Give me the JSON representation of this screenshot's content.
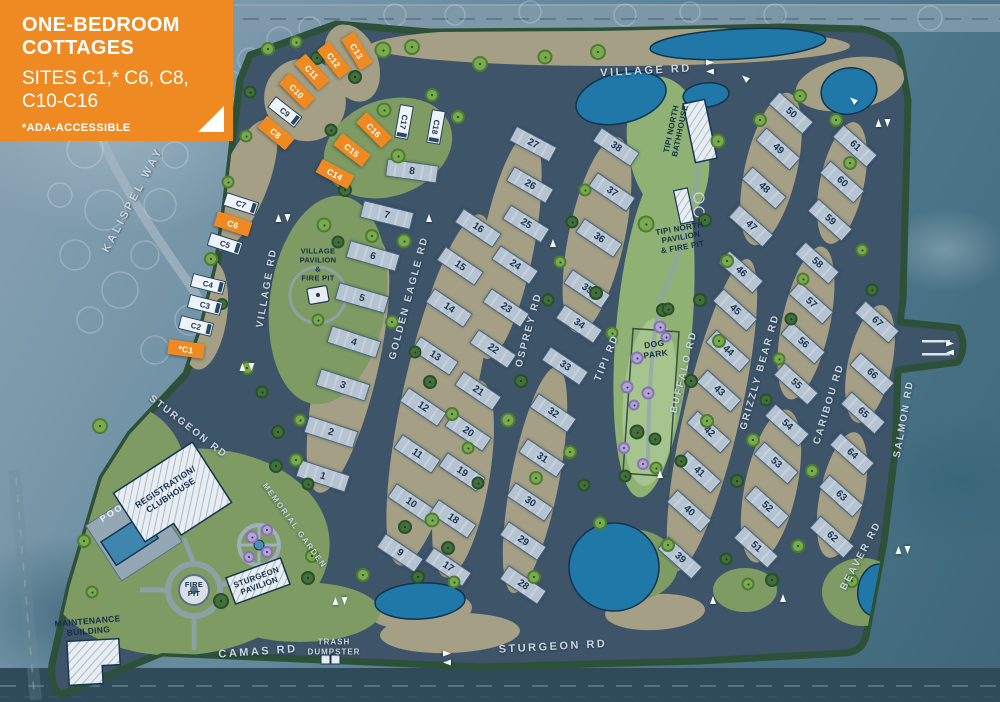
{
  "callout": {
    "title1": "ONE-BEDROOM",
    "title2": "COTTAGES",
    "sites_line1": "SITES C1,* C6, C8,",
    "sites_line2": "C10-C16",
    "note": "*ADA-ACCESSIBLE"
  },
  "colors": {
    "highlight_orange": "#ef8a23",
    "road_asphalt": "#3e5469",
    "gravel_tan": "#a5a085",
    "lawn_green": "#7d9b63",
    "pond_blue": "#1f78a8",
    "pad_gray": "#b6c3d1",
    "perimeter_green": "#2d5039"
  },
  "roads": [
    [
      "KALISPEL WAY",
      133,
      200,
      -62,
      11,
      3
    ],
    [
      "VILLAGE RD",
      267,
      288,
      -80,
      10,
      2
    ],
    [
      "VILLAGE RD",
      646,
      71,
      -3,
      11,
      2.5
    ],
    [
      "STURGEON RD",
      188,
      427,
      38,
      10,
      2
    ],
    [
      "STURGEON RD",
      553,
      647,
      -3,
      11,
      2.5
    ],
    [
      "CAMAS RD",
      258,
      652,
      -4,
      11,
      2.5
    ],
    [
      "GOLDEN EAGLE RD",
      409,
      298,
      -75,
      10,
      2
    ],
    [
      "OSPREY RD",
      529,
      330,
      -75,
      10,
      2
    ],
    [
      "TIPI RD",
      607,
      358,
      -68,
      10,
      2
    ],
    [
      "BUFFALO RD",
      684,
      372,
      -76,
      10,
      2
    ],
    [
      "GRIZZLY BEAR RD",
      760,
      372,
      -74,
      10,
      2
    ],
    [
      "CARIBOU RD",
      829,
      404,
      -73,
      10,
      2
    ],
    [
      "SALMON RD",
      904,
      419,
      -80,
      10,
      2
    ],
    [
      "BEAVER RD",
      861,
      556,
      -62,
      10,
      2
    ],
    [
      "MEMORIAL GARDEN",
      294,
      526,
      54,
      8,
      1.5
    ],
    [
      "TRASH\nDUMPSTER",
      334,
      648,
      0,
      8,
      1
    ]
  ],
  "amenities": [
    [
      "VILLAGE\nPAVILION\n&\nFIRE PIT",
      318,
      265,
      0,
      7.5,
      0
    ],
    [
      "TIPI NORTH\nBATHHOUSE",
      676,
      130,
      -78,
      8,
      0
    ],
    [
      "TIPI NORTH\nPAVILION\n& FIRE PIT",
      681,
      238,
      -10,
      8,
      0
    ],
    [
      "DOG\nPARK",
      655,
      349,
      -8,
      8.5,
      0
    ],
    [
      "REGISTRATION/\nCLUBHOUSE",
      168,
      491,
      -33,
      8.5,
      0
    ],
    [
      "POOL",
      115,
      511,
      -33,
      9,
      1
    ],
    [
      "FIRE\nPIT",
      194,
      590,
      0,
      7.5,
      0
    ],
    [
      "STURGEON\nPAVILION",
      258,
      582,
      -20,
      8,
      0
    ],
    [
      "MAINTENANCE\nBUILDING",
      88,
      626,
      -5,
      8.5,
      0
    ]
  ],
  "cottages": [
    [
      "*C1",
      186,
      349,
      8,
      1
    ],
    [
      "C2",
      196,
      326,
      14,
      0
    ],
    [
      "C3",
      205,
      305,
      14,
      0
    ],
    [
      "C4",
      208,
      284,
      14,
      0
    ],
    [
      "C5",
      225,
      244,
      18,
      0
    ],
    [
      "C6",
      233,
      224,
      18,
      1
    ],
    [
      "C7",
      241,
      204,
      18,
      0
    ],
    [
      "C8",
      276,
      133,
      40,
      1
    ],
    [
      "C9",
      285,
      112,
      38,
      0
    ],
    [
      "C10",
      297,
      91,
      45,
      1
    ],
    [
      "C11",
      312,
      72,
      48,
      1
    ],
    [
      "C12",
      334,
      60,
      52,
      1
    ],
    [
      "C13",
      357,
      51,
      58,
      1
    ],
    [
      "C14",
      335,
      174,
      28,
      1
    ],
    [
      "C15",
      352,
      150,
      38,
      1
    ],
    [
      "C16",
      374,
      130,
      45,
      1
    ],
    [
      "C17",
      404,
      122,
      100,
      0
    ],
    [
      "C18",
      436,
      127,
      100,
      0
    ]
  ],
  "sites": [
    [
      1,
      323,
      476,
      18
    ],
    [
      2,
      331,
      432,
      18
    ],
    [
      3,
      343,
      385,
      18
    ],
    [
      4,
      354,
      342,
      18
    ],
    [
      5,
      362,
      298,
      16
    ],
    [
      6,
      373,
      256,
      16
    ],
    [
      7,
      387,
      215,
      14
    ],
    [
      8,
      412,
      171,
      8
    ],
    [
      9,
      400,
      553,
      34
    ],
    [
      10,
      411,
      503,
      34
    ],
    [
      11,
      417,
      454,
      34
    ],
    [
      12,
      423,
      407,
      34
    ],
    [
      13,
      435,
      356,
      34
    ],
    [
      14,
      449,
      308,
      34
    ],
    [
      15,
      460,
      266,
      34
    ],
    [
      16,
      478,
      228,
      34
    ],
    [
      17,
      448,
      567,
      34
    ],
    [
      18,
      453,
      519,
      34
    ],
    [
      19,
      462,
      472,
      34
    ],
    [
      20,
      468,
      432,
      34
    ],
    [
      21,
      478,
      391,
      34
    ],
    [
      22,
      493,
      349,
      34
    ],
    [
      23,
      506,
      308,
      34
    ],
    [
      24,
      515,
      265,
      34
    ],
    [
      25,
      526,
      224,
      32
    ],
    [
      26,
      530,
      185,
      30
    ],
    [
      27,
      533,
      144,
      28
    ],
    [
      28,
      523,
      585,
      34
    ],
    [
      29,
      523,
      541,
      34
    ],
    [
      30,
      530,
      502,
      34
    ],
    [
      31,
      542,
      458,
      34
    ],
    [
      32,
      553,
      413,
      34
    ],
    [
      33,
      565,
      366,
      34
    ],
    [
      34,
      579,
      324,
      34
    ],
    [
      35,
      587,
      289,
      34
    ],
    [
      36,
      599,
      238,
      34
    ],
    [
      37,
      612,
      192,
      34
    ],
    [
      38,
      616,
      147,
      34
    ],
    [
      39,
      680,
      558,
      42
    ],
    [
      40,
      689,
      511,
      42
    ],
    [
      41,
      699,
      472,
      42
    ],
    [
      42,
      709,
      432,
      42
    ],
    [
      43,
      719,
      391,
      42
    ],
    [
      44,
      728,
      351,
      42
    ],
    [
      45,
      735,
      310,
      42
    ],
    [
      46,
      741,
      272,
      42
    ],
    [
      47,
      751,
      226,
      42
    ],
    [
      48,
      764,
      188,
      42
    ],
    [
      49,
      778,
      149,
      42
    ],
    [
      50,
      791,
      113,
      42
    ],
    [
      51,
      756,
      547,
      42
    ],
    [
      52,
      767,
      507,
      42
    ],
    [
      53,
      776,
      463,
      42
    ],
    [
      54,
      787,
      425,
      42
    ],
    [
      55,
      796,
      384,
      42
    ],
    [
      56,
      803,
      343,
      42
    ],
    [
      57,
      811,
      303,
      42
    ],
    [
      58,
      817,
      263,
      42
    ],
    [
      59,
      830,
      220,
      42
    ],
    [
      60,
      842,
      182,
      42
    ],
    [
      61,
      855,
      146,
      42
    ],
    [
      62,
      832,
      537,
      42
    ],
    [
      63,
      841,
      496,
      42
    ],
    [
      64,
      852,
      454,
      42
    ],
    [
      65,
      863,
      413,
      42
    ],
    [
      66,
      872,
      374,
      42
    ],
    [
      67,
      877,
      322,
      42
    ]
  ],
  "trees": [
    [
      383,
      50,
      "l",
      17
    ],
    [
      412,
      47,
      "l",
      16
    ],
    [
      480,
      64,
      "l",
      16
    ],
    [
      545,
      57,
      "l",
      15
    ],
    [
      598,
      52,
      "l",
      16
    ],
    [
      317,
      58,
      "d",
      14
    ],
    [
      355,
      77,
      "d",
      14
    ],
    [
      268,
      49,
      "l",
      14
    ],
    [
      296,
      42,
      "l",
      13
    ],
    [
      384,
      110,
      "l",
      15
    ],
    [
      398,
      156,
      "l",
      15
    ],
    [
      345,
      190,
      "d",
      14
    ],
    [
      331,
      130,
      "d",
      13
    ],
    [
      432,
      95,
      "l",
      14
    ],
    [
      458,
      117,
      "l",
      14
    ],
    [
      250,
      92,
      "d",
      13
    ],
    [
      246,
      136,
      "l",
      13
    ],
    [
      228,
      182,
      "l",
      13
    ],
    [
      211,
      259,
      "l",
      14
    ],
    [
      222,
      304,
      "d",
      12
    ],
    [
      247,
      368,
      "l",
      14
    ],
    [
      262,
      392,
      "d",
      13
    ],
    [
      278,
      432,
      "d",
      14
    ],
    [
      296,
      460,
      "l",
      14
    ],
    [
      308,
      484,
      "d",
      13
    ],
    [
      324,
      225,
      "l",
      15
    ],
    [
      338,
      242,
      "d",
      13
    ],
    [
      372,
      236,
      "l",
      14
    ],
    [
      318,
      320,
      "l",
      13
    ],
    [
      300,
      420,
      "l",
      13
    ],
    [
      404,
      241,
      "l",
      15
    ],
    [
      392,
      322,
      "l",
      14
    ],
    [
      415,
      352,
      "d",
      13
    ],
    [
      430,
      382,
      "d",
      14
    ],
    [
      452,
      414,
      "l",
      14
    ],
    [
      432,
      520,
      "l",
      15
    ],
    [
      448,
      548,
      "d",
      14
    ],
    [
      468,
      448,
      "l",
      13
    ],
    [
      478,
      483,
      "d",
      13
    ],
    [
      508,
      420,
      "l",
      15
    ],
    [
      521,
      381,
      "d",
      14
    ],
    [
      536,
      478,
      "l",
      14
    ],
    [
      548,
      300,
      "d",
      13
    ],
    [
      560,
      262,
      "l",
      13
    ],
    [
      572,
      222,
      "d",
      13
    ],
    [
      585,
      190,
      "l",
      13
    ],
    [
      596,
      293,
      "d",
      14
    ],
    [
      612,
      333,
      "l",
      13
    ],
    [
      570,
      452,
      "l",
      14
    ],
    [
      584,
      485,
      "d",
      13
    ],
    [
      600,
      523,
      "l",
      14
    ],
    [
      625,
      476,
      "d",
      13
    ],
    [
      646,
      224,
      "l",
      17
    ],
    [
      663,
      310,
      "d",
      14
    ],
    [
      637,
      432,
      "d",
      15
    ],
    [
      656,
      468,
      "l",
      13
    ],
    [
      668,
      309,
      "d",
      13
    ],
    [
      655,
      439,
      "d",
      13
    ],
    [
      718,
      141,
      "l",
      15
    ],
    [
      705,
      220,
      "d",
      14
    ],
    [
      727,
      261,
      "l",
      14
    ],
    [
      700,
      300,
      "d",
      14
    ],
    [
      719,
      341,
      "l",
      14
    ],
    [
      691,
      381,
      "d",
      14
    ],
    [
      707,
      421,
      "l",
      14
    ],
    [
      681,
      461,
      "d",
      13
    ],
    [
      737,
      481,
      "d",
      14
    ],
    [
      753,
      440,
      "l",
      14
    ],
    [
      766,
      400,
      "d",
      13
    ],
    [
      779,
      359,
      "l",
      13
    ],
    [
      791,
      319,
      "d",
      13
    ],
    [
      803,
      279,
      "l",
      13
    ],
    [
      760,
      120,
      "l",
      14
    ],
    [
      800,
      96,
      "l",
      14
    ],
    [
      836,
      120,
      "l",
      14
    ],
    [
      850,
      163,
      "l",
      14
    ],
    [
      862,
      250,
      "l",
      13
    ],
    [
      872,
      290,
      "d",
      13
    ],
    [
      812,
      471,
      "l",
      14
    ],
    [
      798,
      546,
      "l",
      14
    ],
    [
      772,
      580,
      "d",
      14
    ],
    [
      748,
      584,
      "l",
      13
    ],
    [
      852,
      581,
      "l",
      14
    ],
    [
      726,
      559,
      "d",
      13
    ],
    [
      100,
      426,
      "l",
      16
    ],
    [
      84,
      541,
      "l",
      14
    ],
    [
      92,
      592,
      "l",
      13
    ],
    [
      221,
      601,
      "d",
      16
    ],
    [
      276,
      466,
      "d",
      14
    ],
    [
      405,
      527,
      "d",
      14
    ],
    [
      312,
      556,
      "l",
      14
    ],
    [
      308,
      578,
      "d",
      14
    ],
    [
      363,
      575,
      "l",
      14
    ],
    [
      418,
      577,
      "d",
      14
    ],
    [
      454,
      582,
      "l",
      13
    ],
    [
      534,
      577,
      "l",
      14
    ],
    [
      668,
      545,
      "l",
      14
    ],
    [
      252,
      537,
      "p",
      13
    ],
    [
      267,
      530,
      "p",
      12
    ],
    [
      249,
      557,
      "p",
      12
    ],
    [
      267,
      552,
      "p",
      12
    ],
    [
      660,
      327,
      "p",
      13
    ],
    [
      666,
      337,
      "p",
      11
    ],
    [
      637,
      358,
      "p",
      13
    ],
    [
      627,
      387,
      "p",
      13
    ],
    [
      648,
      393,
      "p",
      13
    ],
    [
      634,
      405,
      "p",
      11
    ],
    [
      624,
      448,
      "p",
      12
    ],
    [
      643,
      464,
      "p",
      12
    ]
  ],
  "arrows": [
    [
      283,
      218,
      0,
      0
    ],
    [
      247,
      367,
      0,
      0
    ],
    [
      340,
      601,
      0,
      0
    ],
    [
      447,
      658,
      90,
      0
    ],
    [
      710,
      67,
      90,
      0
    ],
    [
      883,
      123,
      0,
      0
    ],
    [
      950,
      348,
      90,
      0
    ],
    [
      903,
      550,
      0,
      0
    ],
    [
      745,
      78,
      -50,
      1
    ],
    [
      853,
      100,
      -50,
      1
    ],
    [
      429,
      218,
      0,
      1
    ],
    [
      553,
      243,
      0,
      1
    ],
    [
      660,
      474,
      0,
      1
    ],
    [
      713,
      600,
      0,
      1
    ],
    [
      783,
      598,
      0,
      1
    ]
  ]
}
